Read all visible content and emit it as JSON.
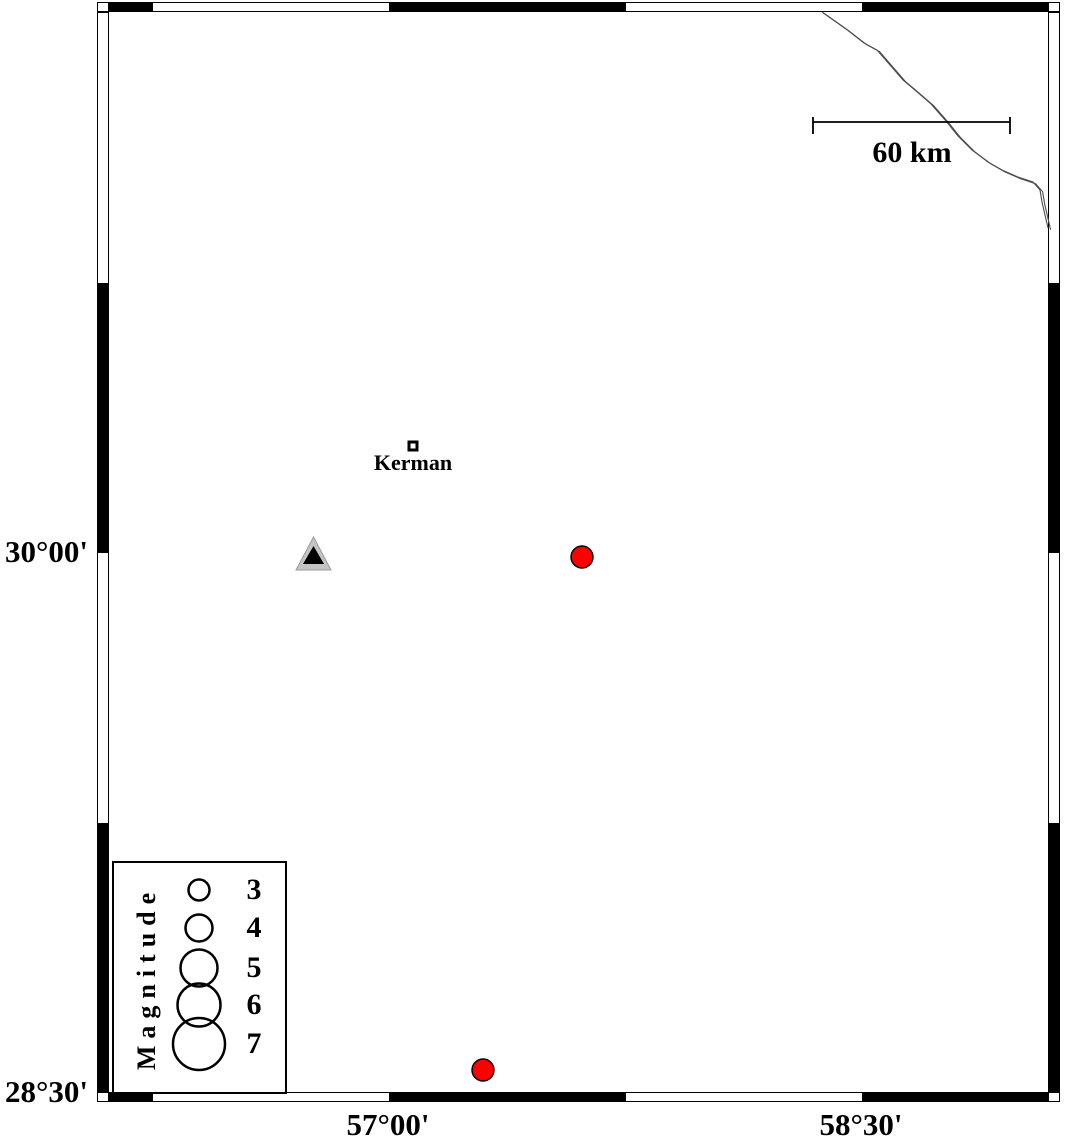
{
  "map": {
    "type": "seismicity-map",
    "region_name": "Kerman region, Iran",
    "bounds": {
      "west_lon": "56°07'E",
      "east_lon": "59°06'E",
      "south_lat": "28°30'N",
      "north_lat": "31°30'N"
    },
    "frame": {
      "style": "double-line fancy frame, alternating black/white 45-arcmin segments",
      "lat_annotations": [
        {
          "label": "30°00'"
        },
        {
          "label": "28°30'"
        }
      ],
      "lon_annotations": [
        {
          "label": "57°00'"
        },
        {
          "label": "58°30'"
        }
      ]
    },
    "scale_bar": {
      "label": "60 km",
      "length_km": 60,
      "position": "top-right"
    },
    "city": {
      "label": "Kerman",
      "marker": "small open square",
      "approx_lat": 30.29,
      "approx_lon": 57.08
    },
    "station": {
      "marker": "triangle (gray with black core)",
      "approx_lat": 29.99,
      "approx_lon": 56.76,
      "fill": "#c4c4c4",
      "core_fill": "#000000"
    },
    "earthquakes": [
      {
        "approx_lat": 29.99,
        "approx_lon": 57.62,
        "fill": "#ff0000",
        "outline": "#000000",
        "approx_magnitude": 3.5
      },
      {
        "approx_lat": 28.56,
        "approx_lon": 57.3,
        "fill": "#ff0000",
        "outline": "#000000",
        "approx_magnitude": 3.5
      }
    ],
    "road": {
      "style": "thin double line",
      "color": "#4d4d4d",
      "from": "top edge near 58°23'E",
      "to": "right edge near 30°54'N"
    },
    "legend": {
      "title": "Magnitude",
      "entries": [
        {
          "label": "3",
          "magnitude": 3
        },
        {
          "label": "4",
          "magnitude": 4
        },
        {
          "label": "5",
          "magnitude": 5
        },
        {
          "label": "6",
          "magnitude": 6
        },
        {
          "label": "7",
          "magnitude": 7
        }
      ]
    },
    "colors": {
      "background": "#ffffff",
      "frame": "#000000",
      "earthquake_fill": "#ff0000",
      "station_gray": "#c4c4c4"
    }
  }
}
